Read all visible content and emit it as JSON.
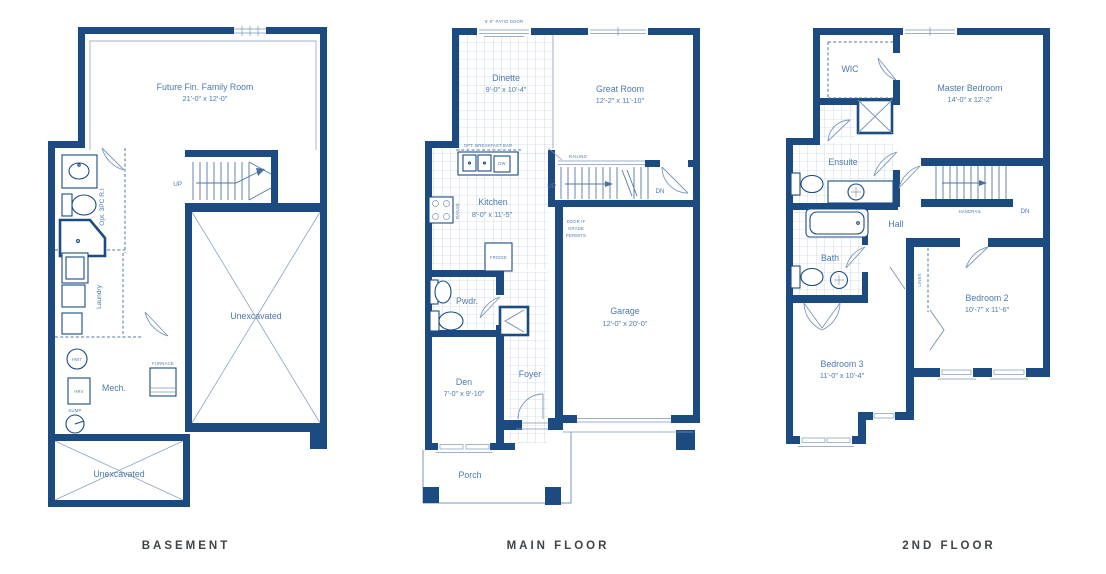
{
  "document": {
    "type": "floor-plan-sheet"
  },
  "colors": {
    "wall": "#1b4b80",
    "thin_line": "#7d96b8",
    "tile_line": "#b0c1d8",
    "label_text": "#4d79ab",
    "title_text": "#3e4347",
    "background": "#ffffff"
  },
  "basement": {
    "title": "BASEMENT",
    "labels": {
      "family_room": "Future Fin. Family Room",
      "family_room_dims": "21'-0\" x 12'-0\"",
      "up": "UP",
      "opt_3pc": "Opt. 3PC R.I",
      "laundry": "Laundry",
      "mech": "Mech.",
      "hwt": "HWT",
      "hrv": "HRV",
      "furnace": "FURNACE",
      "sump": "SUMP",
      "unexcavated_main": "Unexcavated",
      "unexcavated_small": "Unexcavated"
    }
  },
  "main_floor": {
    "title": "MAIN FLOOR",
    "labels": {
      "patio_door": "5'-0\" PATIO DOOR",
      "dinette": "Dinette",
      "dinette_dims": "9'-0\" x 10'-4\"",
      "great_room": "Great Room",
      "great_room_dims": "12'-2\" x 11'-10\"",
      "opt_breakfast_bar": "OPT. BREAKFAST BAR",
      "kitchen": "Kitchen",
      "kitchen_dims": "8'-0\" x 11'-5\"",
      "railing": "RAILING",
      "up": "UP",
      "dn": "DN",
      "door_grade_1": "DOOR IF",
      "door_grade_2": "GRADE",
      "door_grade_3": "PERMITS",
      "range": "RANGE",
      "dw": "DW",
      "fridge": "FRIDGE",
      "pwdr": "Pwdr.",
      "garage": "Garage",
      "garage_dims": "12'-0\" x 20'-0\"",
      "den": "Den",
      "den_dims": "7'-0\" x 9'-10\"",
      "foyer": "Foyer",
      "porch": "Porch"
    }
  },
  "second_floor": {
    "title": "2ND FLOOR",
    "labels": {
      "wic": "WIC",
      "master": "Master Bedroom",
      "master_dims": "14'-0\" x 12'-2\"",
      "ensuite": "Ensuite",
      "hall": "Hall",
      "handrail": "HANDRAIL",
      "dn": "DN",
      "bath": "Bath",
      "linen": "LINEN",
      "bedroom2": "Bedroom 2",
      "bedroom2_dims": "10'-7\" x 11'-6\"",
      "bedroom3": "Bedroom 3",
      "bedroom3_dims": "11'-0\" x 10'-4\""
    }
  }
}
